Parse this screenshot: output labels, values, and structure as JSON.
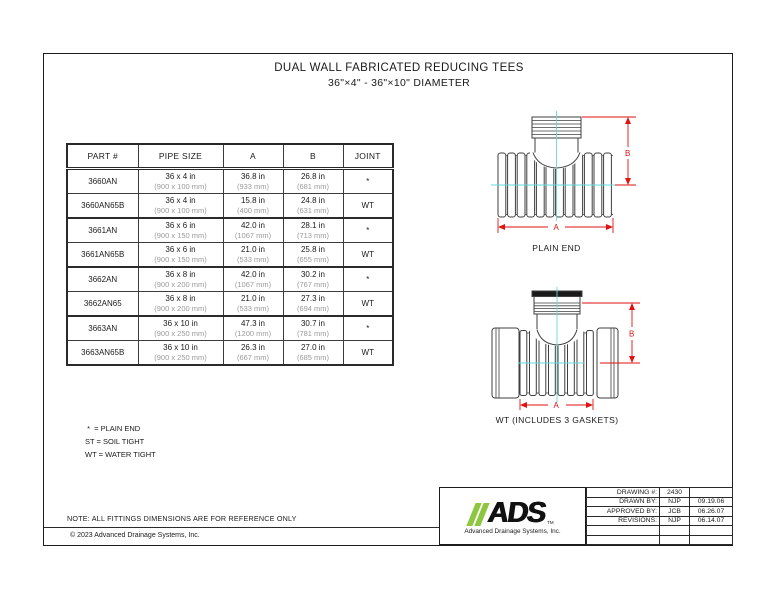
{
  "page": {
    "title_line1": "DUAL WALL FABRICATED REDUCING TEES",
    "title_line2": "36\"×4\" - 36\"×10\" DIAMETER",
    "note": "NOTE: ALL FITTINGS DIMENSIONS ARE FOR REFERENCE ONLY",
    "copyright": "© 2023 Advanced Drainage Systems, Inc."
  },
  "table": {
    "headers": [
      "PART #",
      "PIPE SIZE",
      "A",
      "B",
      "JOINT"
    ],
    "rows": [
      {
        "part": "3660AN",
        "size_in": "36 x 4 in",
        "size_mm": "(900 x 100 mm)",
        "a_in": "36.8 in",
        "a_mm": "(933 mm)",
        "b_in": "26.8 in",
        "b_mm": "(681 mm)",
        "joint": "*"
      },
      {
        "part": "3660AN65B",
        "size_in": "36 x 4 in",
        "size_mm": "(900 x 100 mm)",
        "a_in": "15.8 in",
        "a_mm": "(400 mm)",
        "b_in": "24.8 in",
        "b_mm": "(631 mm)",
        "joint": "WT"
      },
      {
        "part": "3661AN",
        "size_in": "36 x 6 in",
        "size_mm": "(900 x 150 mm)",
        "a_in": "42.0 in",
        "a_mm": "(1067 mm)",
        "b_in": "28.1 in",
        "b_mm": "(713 mm)",
        "joint": "*"
      },
      {
        "part": "3661AN65B",
        "size_in": "36 x 6 in",
        "size_mm": "(900 x 150 mm)",
        "a_in": "21.0 in",
        "a_mm": "(533 mm)",
        "b_in": "25.8 in",
        "b_mm": "(655 mm)",
        "joint": "WT"
      },
      {
        "part": "3662AN",
        "size_in": "36 x 8 in",
        "size_mm": "(900 x 200 mm)",
        "a_in": "42.0 in",
        "a_mm": "(1067 mm)",
        "b_in": "30.2 in",
        "b_mm": "(767 mm)",
        "joint": "*"
      },
      {
        "part": "3662AN65",
        "size_in": "36 x 8 in",
        "size_mm": "(900 x 200 mm)",
        "a_in": "21.0 in",
        "a_mm": "(533 mm)",
        "b_in": "27.3 in",
        "b_mm": "(694 mm)",
        "joint": "WT"
      },
      {
        "part": "3663AN",
        "size_in": "36 x 10 in",
        "size_mm": "(900 x 250 mm)",
        "a_in": "47.3 in",
        "a_mm": "(1200 mm)",
        "b_in": "30.7 in",
        "b_mm": "(781 mm)",
        "joint": "*"
      },
      {
        "part": "3663AN65B",
        "size_in": "36 x 10 in",
        "size_mm": "(900 x 250 mm)",
        "a_in": "26.3 in",
        "a_mm": "(667 mm)",
        "b_in": "27.0 in",
        "b_mm": "(685 mm)",
        "joint": "WT"
      }
    ]
  },
  "legend": {
    "line1": " *  = PLAIN END",
    "line2": "ST = SOIL TIGHT",
    "line3": "WT = WATER TIGHT"
  },
  "diagrams": {
    "plain_end": {
      "caption": "PLAIN END",
      "dim_a": "A",
      "dim_b": "B"
    },
    "water_tight": {
      "caption": "WT (INCLUDES 3 GASKETS)",
      "dim_a": "A",
      "dim_b": "B"
    }
  },
  "titleblock": {
    "logo_text": "ADS",
    "logo_tm": "TM",
    "logo_subtitle": "Advanced Drainage Systems, Inc.",
    "rows": [
      {
        "label": "DRAWING #:",
        "value": "2430",
        "date": ""
      },
      {
        "label": "DRAWN BY:",
        "value": "NJP",
        "date": "09.19.06"
      },
      {
        "label": "APPROVED BY:",
        "value": "JCB",
        "date": "06.26.07"
      },
      {
        "label": "REVISIONS:",
        "value": "NJP",
        "date": "06.14.07"
      },
      {
        "label": "",
        "value": "",
        "date": ""
      },
      {
        "label": "",
        "value": "",
        "date": ""
      }
    ]
  },
  "colors": {
    "dimension_red": "#e01212",
    "centerline_cyan": "#66d9d9",
    "logo_green": "#8dc63f",
    "secondary_gray": "#9a9a9a"
  }
}
